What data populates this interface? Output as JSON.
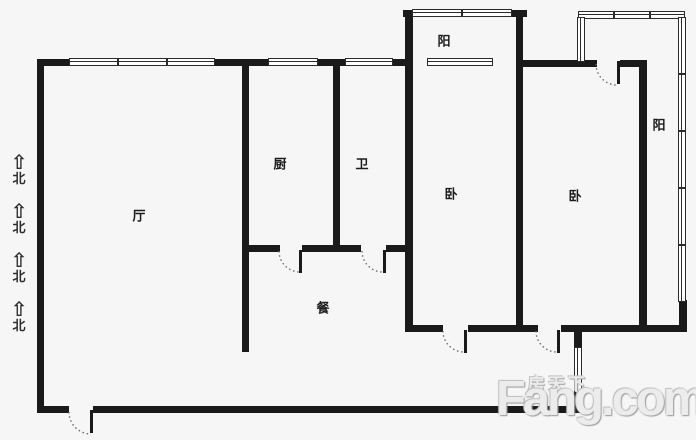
{
  "colors": {
    "background": "#f6f6f6",
    "wall": "#1a1a1a",
    "label": "#1c1c1c",
    "watermark": "#ececec"
  },
  "rooms": [
    {
      "id": "living",
      "label": "厅"
    },
    {
      "id": "kitchen",
      "label": "厨"
    },
    {
      "id": "bathroom",
      "label": "卫"
    },
    {
      "id": "bedroom-1",
      "label": "卧"
    },
    {
      "id": "bedroom-2",
      "label": "卧"
    },
    {
      "id": "balcony-top",
      "label": "阳"
    },
    {
      "id": "balcony-right",
      "label": "阳"
    },
    {
      "id": "dining",
      "label": "餐"
    }
  ],
  "north": {
    "arrow": "⇧",
    "label": "北",
    "count": 4
  },
  "watermark": {
    "cn": "房天下",
    "en": "Fang.com"
  }
}
